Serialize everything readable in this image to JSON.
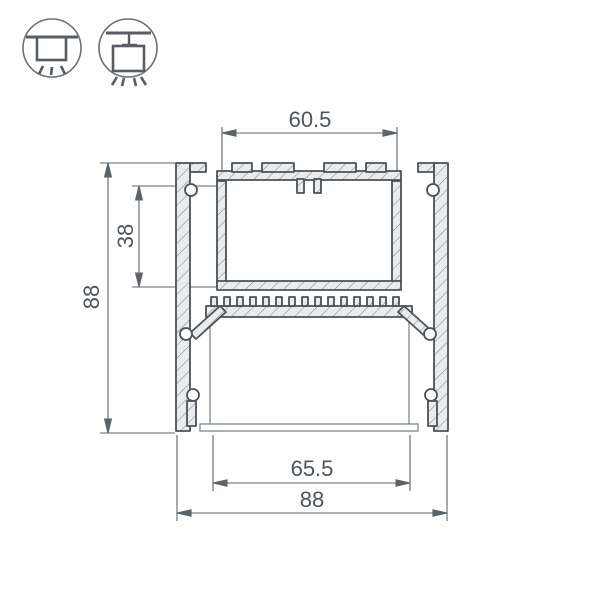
{
  "drawing": {
    "type": "led-profile-cross-section",
    "dimensions": {
      "top_slot_width": "60.5",
      "upper_channel_depth": "38",
      "overall_height": "88",
      "diffuser_width": "65.5",
      "overall_width": "88"
    }
  },
  "mounting_icons": {
    "surface": "surface-mount",
    "pendant": "pendant-mount"
  },
  "colors": {
    "profile_line": "#4a5258",
    "hatch_fill": "#e9ebec",
    "dimension_line": "#5c636a",
    "dimension_text": "#4d545a",
    "icon_stroke": "#565d63",
    "icon_circle": "#6a7177",
    "diffuser_line": "#767d82"
  }
}
